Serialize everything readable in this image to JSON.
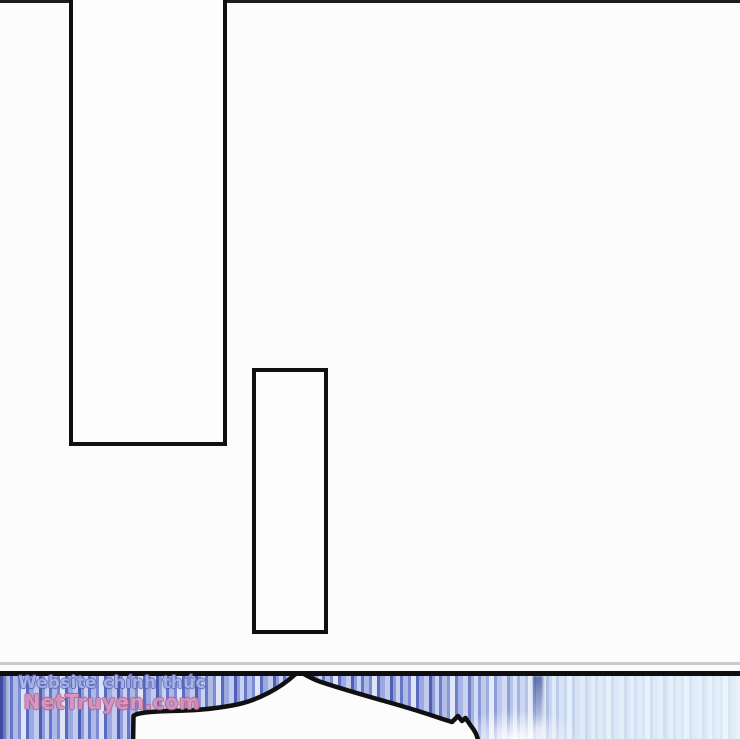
{
  "comic_page": {
    "background_color": "#fcfcfc",
    "ink_color": "#101010",
    "separator_color": "#c9cbcf"
  },
  "watermark": {
    "line1": "Website chính thức",
    "line2": "NetTruyen.com",
    "line1_color": "#a6b2ea",
    "line2_color": "#de93ba"
  },
  "bottom_panel": {
    "stripe_colors": [
      "#4f5fb4",
      "#8d9bda",
      "#c9d2f0",
      "#6577c6",
      "#aeb9e6",
      "#7d8cd2",
      "#dfe5f6"
    ],
    "right_fade_color": "#e8f3fa",
    "bubble_fill": "#fcfcfc"
  }
}
